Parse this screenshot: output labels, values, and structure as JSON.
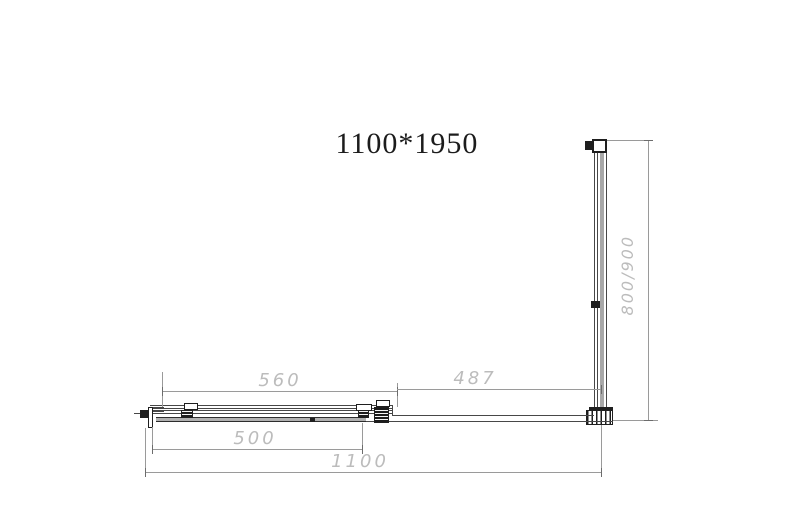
{
  "title": "1100*1950",
  "drawing": {
    "type": "shower-enclosure-plan-view",
    "dimensions": {
      "door_opening_width": "560",
      "fixed_panel_width": "487",
      "sliding_door_width": "500",
      "overall_width": "1100",
      "side_panel_depth": "800/900"
    },
    "colors": {
      "background": "#ffffff",
      "drawing_line": "#474747",
      "dimension_line": "#9a9a9a",
      "dimension_text": "#bcbcbc",
      "glass": "#b0b0b0",
      "title_text": "#1c1c1c"
    }
  }
}
